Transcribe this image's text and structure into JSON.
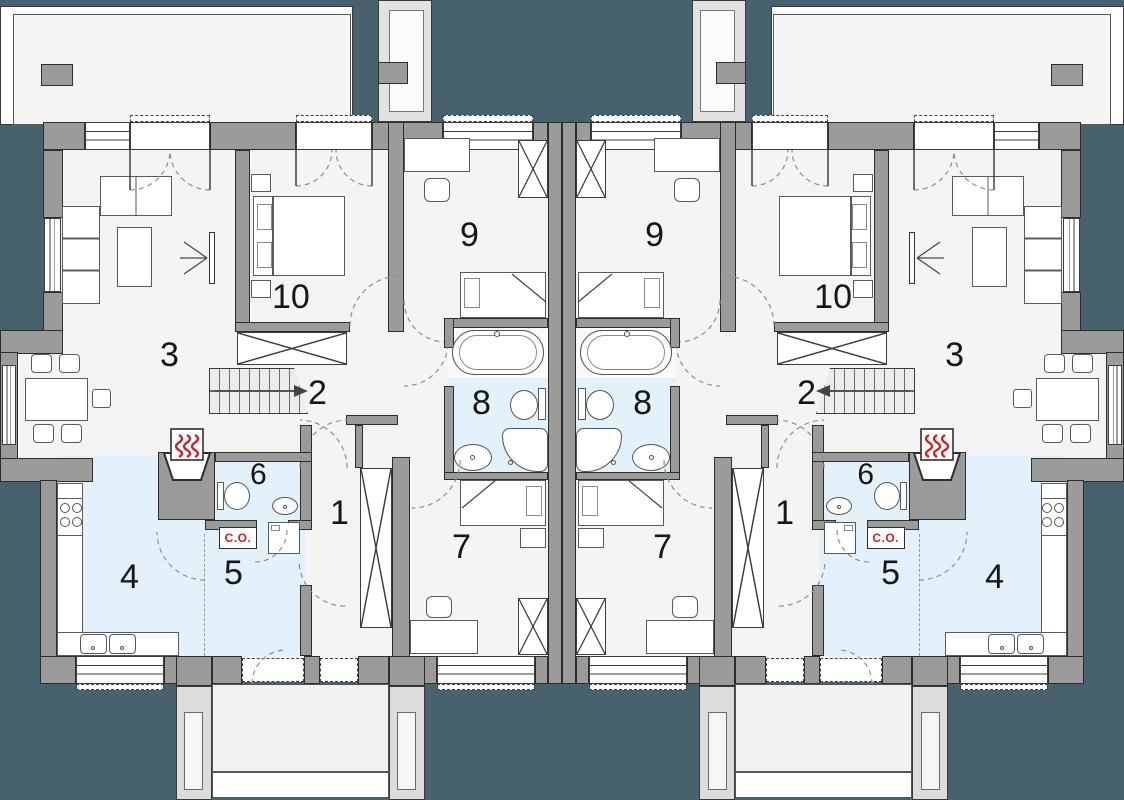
{
  "plan_type": "duplex-floor-plan",
  "colors": {
    "background_teal": "#47626d",
    "wall_gray": "#9b9b99",
    "floor_light": "#f4f4f4",
    "wet_room_blue": "#e3f1fa",
    "terrace_white": "#f5f5f5",
    "accent_red": "#cc2127",
    "outline_dark": "#2e2e2e"
  },
  "units": [
    {
      "side": "left",
      "co": "C.O.",
      "rooms": {
        "1": "1",
        "2": "2",
        "3": "3",
        "4": "4",
        "5": "5",
        "6": "6",
        "7": "7",
        "8": "8",
        "9": "9",
        "10": "10"
      }
    },
    {
      "side": "right",
      "co": "C.O.",
      "rooms": {
        "1": "1",
        "2": "2",
        "3": "3",
        "4": "4",
        "5": "5",
        "6": "6",
        "7": "7",
        "8": "8",
        "9": "9",
        "10": "10"
      }
    }
  ]
}
